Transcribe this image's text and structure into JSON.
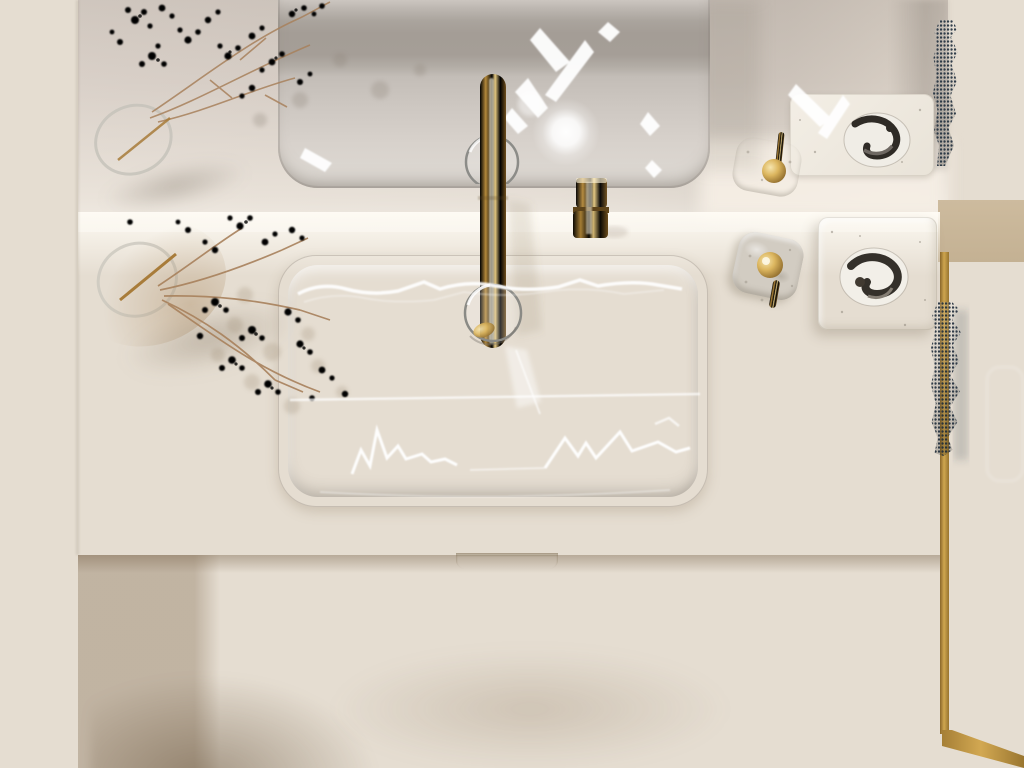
{
  "palette": {
    "wall-tan-dark": "#a99276",
    "wall-tan": "#c3ad8e",
    "wall-glow": "#f2e7cf",
    "mirror-wall": "#d6cdc4",
    "counter": "#f4ede1",
    "counter-bright": "#fbf6ec",
    "counter-edge": "#dcd1be",
    "sink-rim": "#ccc5bc",
    "sink-gray": "#c7c0b8",
    "sink-low": "#d0c9c1",
    "sink-dark": "#bdb6ae",
    "gold-bright": "#f2dda3",
    "gold-mid": "#c79b44",
    "gold-dark": "#6f4f1d",
    "gold-frame-dark": "#8f6c2c",
    "pull-gold": "#8a6527",
    "band-dark": "#b6aea3",
    "floor": "#dfc9a7",
    "floor-light": "#e6d2b1",
    "glass": "#e9dcc4",
    "towel": "#56ILLEGAL",
    "vase": "#97938a",
    "vase-hole": "#241f18",
    "stone": "#ccc6bb",
    "tray": "#f8f4ec",
    "branch": "#b18a62",
    "branch-light": "#c9a47a",
    "wallr-dark": "#978e86",
    "wallr-light": "#cfc5bb"
  },
  "objects": {
    "scene": "Top-down view of a bathroom vanity with gold fixtures",
    "mirror": "wall mirror reflection",
    "ledge": "fluted mirror ledge",
    "counter": "white vanity countertop",
    "sink": "undermount rectangular sink",
    "sink_reflection": "sink reflection in mirror",
    "faucet": "gold faucet",
    "soap_dispenser": "gold soap dispenser pump",
    "vase": "ceramic vase with dried branches",
    "vase_reflection": "vase reflection in mirror",
    "branches": "dried flower branches",
    "stone_dish": "travertine dish with gold handle",
    "soap_tray": "marble soap tray",
    "soap": "marbled soap bar",
    "towel": "navy knit towel",
    "shower_glass": "glass shower panel with gold frame",
    "floor": "beige stone tile floor",
    "drawer_pull": "gold drawer pull",
    "wall": "beige side wall",
    "light_orb": "ceiling light reflection"
  }
}
